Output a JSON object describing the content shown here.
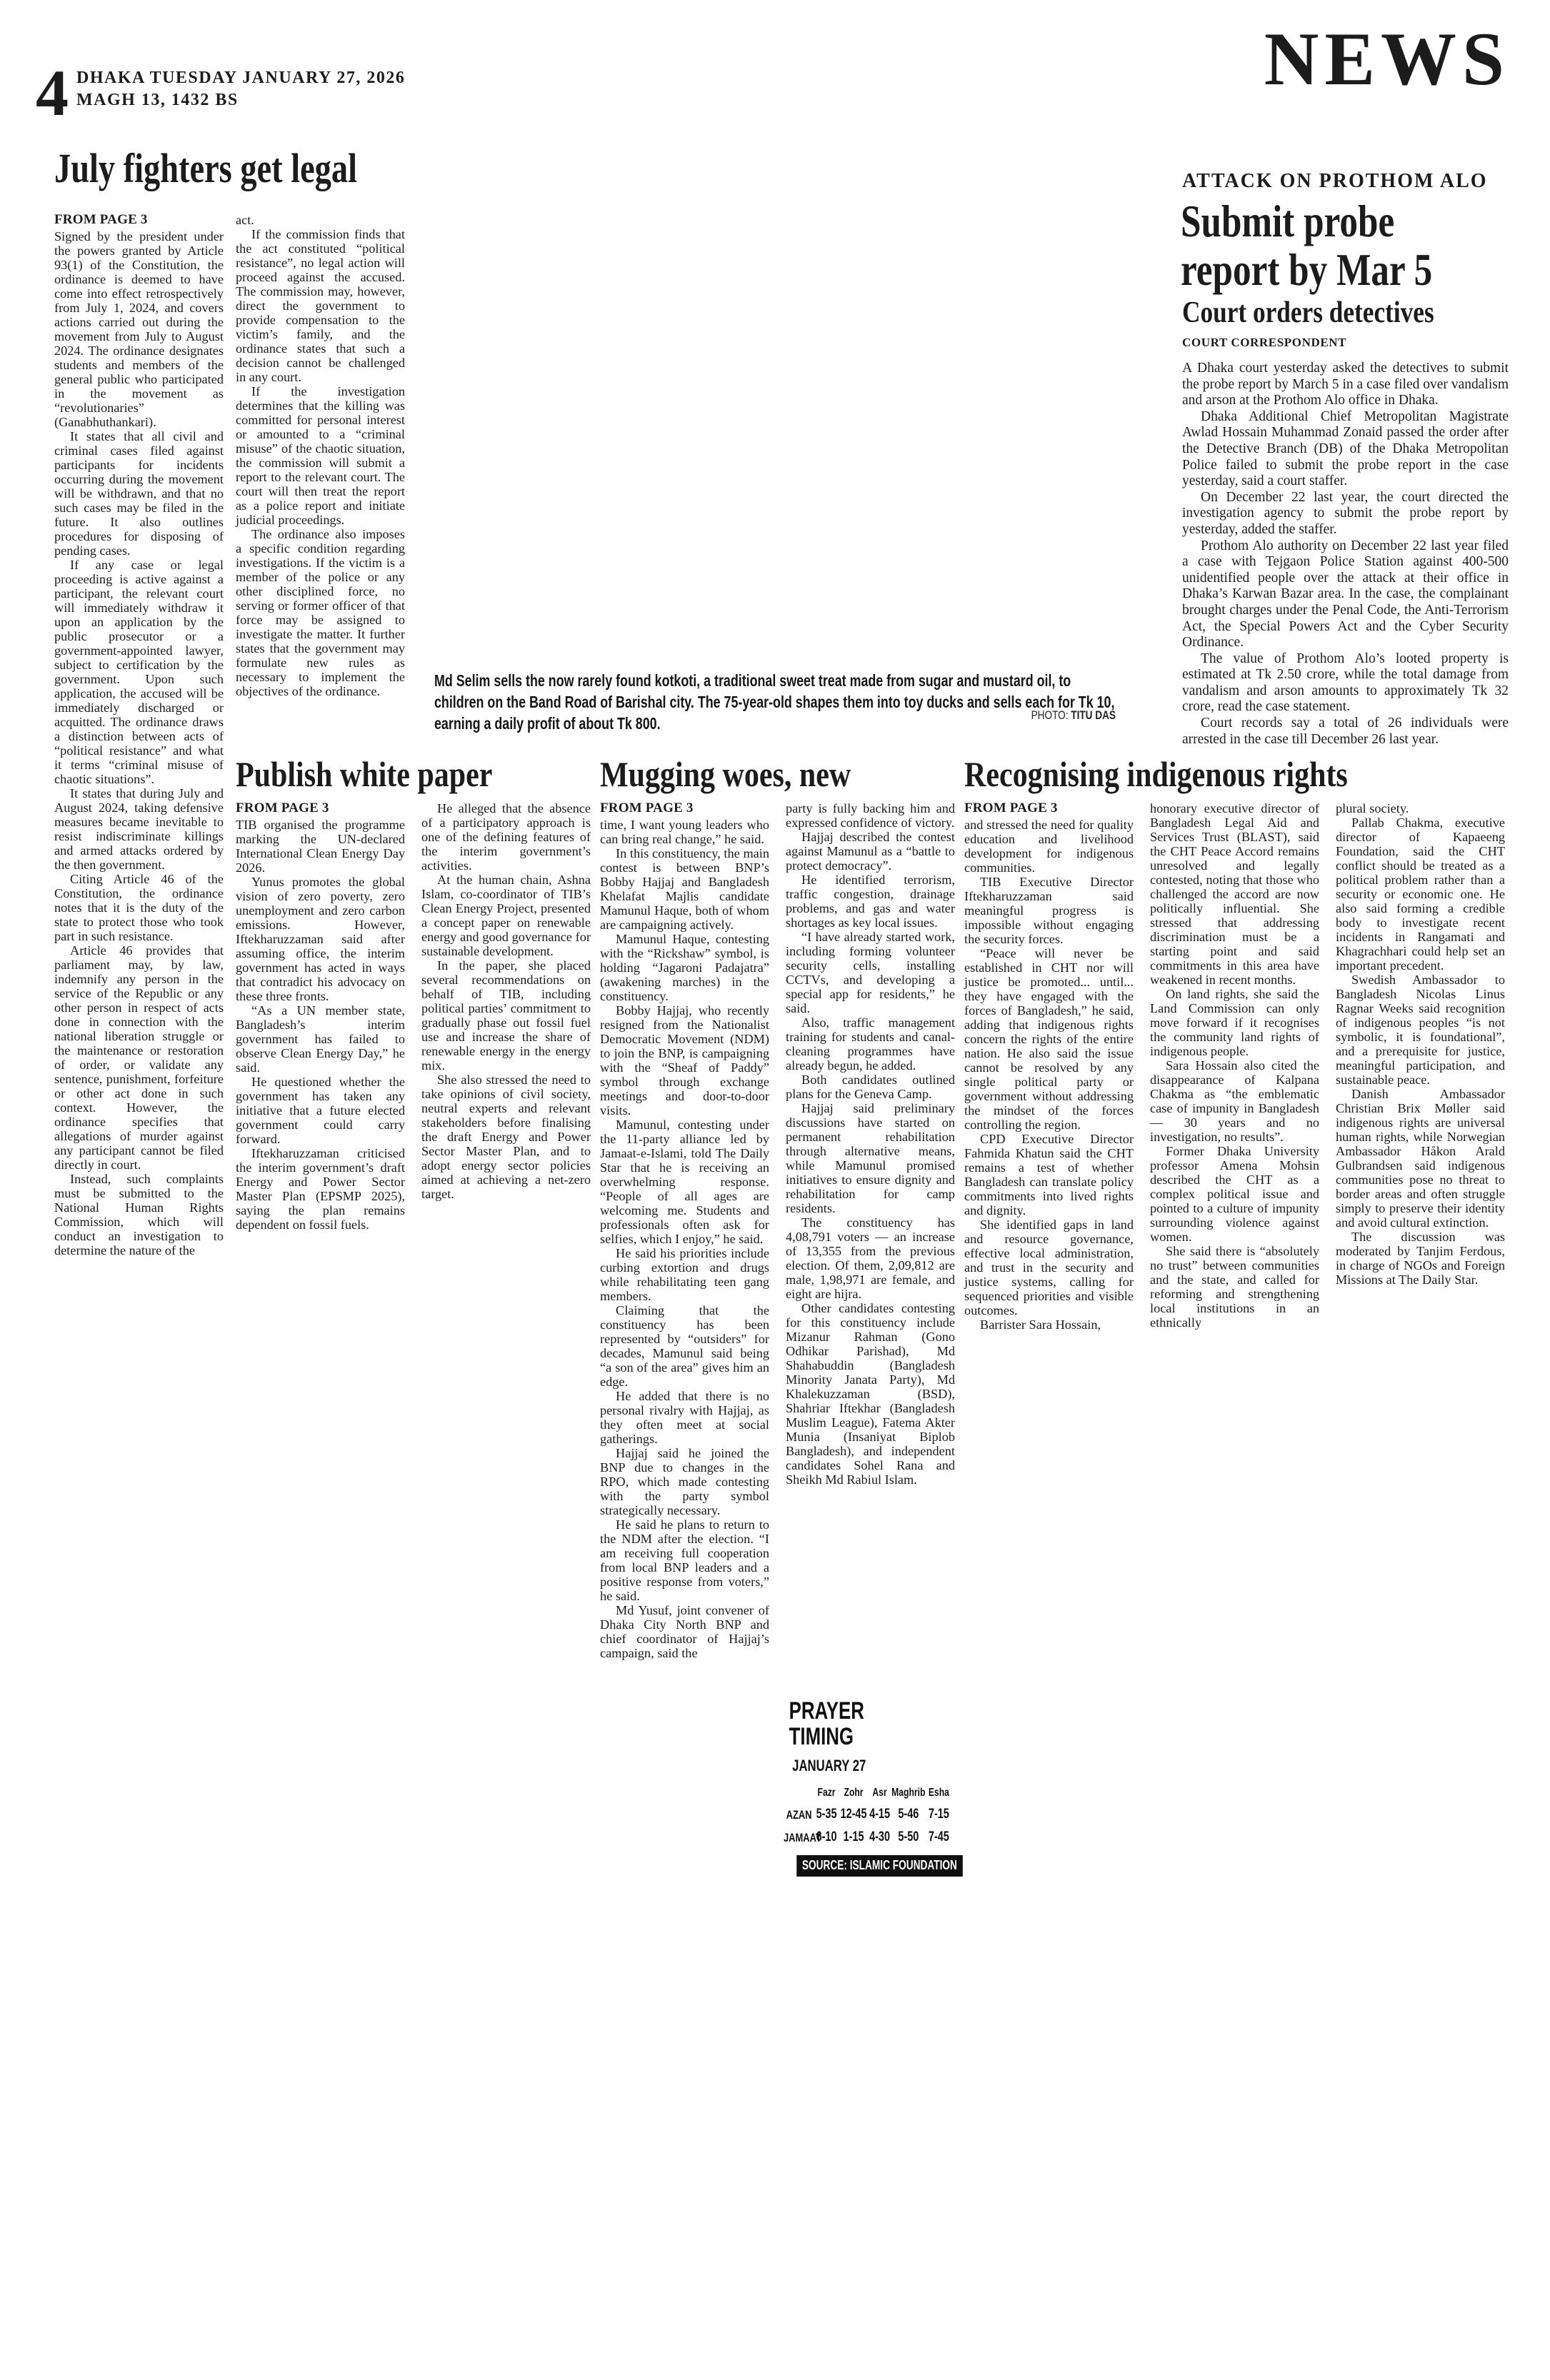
{
  "page": {
    "number": "4",
    "dateline1": "DHAKA TUESDAY JANUARY 27, 2026",
    "dateline2": "MAGH 13, 1432 BS",
    "section": "NEWS"
  },
  "articles": {
    "july": {
      "headline": "July fighters get legal",
      "from_page": "FROM PAGE 3",
      "col1": [
        "Signed by the president under the powers granted by Article 93(1) of the Constitution, the ordinance is deemed to have come into effect retrospectively from July 1, 2024, and covers actions carried out during the movement from July to August 2024. The ordinance designates students and members of the general public who participated in the movement as “revolutionaries” (Ganabhuthankari).",
        "It states that all civil and criminal cases filed against participants for incidents occurring during the movement will be withdrawn, and that no such cases may be filed in the future. It also outlines procedures for disposing of pending cases.",
        "If any case or legal proceeding is active against a participant, the relevant court will immediately withdraw it upon an application by the public prosecutor or a government-appointed lawyer, subject to certification by the government. Upon such application, the accused will be immediately discharged or acquitted. The ordinance draws a distinction between acts of “political resistance” and what it terms “criminal misuse of chaotic situations”.",
        "It states that during July and August 2024, taking defensive measures became inevitable to resist indiscriminate killings and armed attacks ordered by the then government.",
        "Citing Article 46 of the Constitution, the ordinance notes that it is the duty of the state to protect those who took part in such resistance.",
        "Article 46 provides that parliament may, by law, indemnify any person in the service of the Republic or any other person in respect of acts done in connection with the national liberation struggle or the maintenance or restoration of order, or validate any sentence, punishment, forfeiture or other act done in such context. However, the ordinance specifies that allegations of murder against any participant cannot be filed directly in court.",
        "Instead, such complaints must be submitted to the National Human Rights Commission, which will conduct an investigation to determine the nature of the"
      ],
      "col2": [
        "act.",
        "If the commission finds that the act constituted “political resistance”, no legal action will proceed against the accused. The commission may, however, direct the government to provide compensation to the victim’s family, and the ordinance states that such a decision cannot be challenged in any court.",
        "If the investigation determines that the killing was committed for personal interest or amounted to a “criminal misuse” of the chaotic situation, the commission will submit a report to the relevant court. The court will then treat the report as a police report and initiate judicial proceedings.",
        "The ordinance also imposes a specific condition regarding investigations. If the victim is a member of the police or any other disciplined force, no serving or former officer of that force may be assigned to investigate the matter. It further states that the government may formulate new rules as necessary to implement the objectives of the ordinance."
      ]
    },
    "caption": {
      "text": "Md Selim sells the now rarely found kotkoti, a traditional sweet treat made from sugar and mustard oil, to children on the Band Road of Barishal city. The 75-year-old shapes them into toy ducks and sells each for Tk 10, earning a daily profit of about Tk 800.",
      "credit_label": "PHOTO:",
      "credit_name": "TITU DAS"
    },
    "probe": {
      "kicker": "ATTACK ON PROTHOM ALO",
      "headline_line1": "Submit probe",
      "headline_line2": "report by Mar 5",
      "subhead": "Court orders detectives",
      "byline": "COURT CORRESPONDENT",
      "paras": [
        "A Dhaka court yesterday asked the detectives to submit the probe report by March 5 in a case filed over vandalism and arson at the Prothom Alo office in Dhaka.",
        "Dhaka Additional Chief Metropolitan Magistrate Awlad Hossain Muhammad Zonaid passed the order after the Detective Branch (DB) of the Dhaka Metropolitan Police failed to submit the probe report in the case yesterday, said a court staffer.",
        "On December 22 last year, the court directed the investigation agency to submit the probe report by yesterday, added the staffer.",
        "Prothom Alo authority on December 22 last year filed a case with Tejgaon Police Station against 400-500 unidentified people over the attack at their office in Dhaka’s Karwan Bazar area. In the case, the complainant brought charges under the Penal Code, the Anti-Terrorism Act, the Special Powers Act and the Cyber Security Ordinance.",
        "The value of Prothom Alo’s looted property is estimated at Tk 2.50 crore, while the total damage from vandalism and arson amounts to approximately Tk 32 crore, read the case statement.",
        "Court records say a total of 26 individuals were arrested in the case till December 26 last year."
      ]
    },
    "white_paper": {
      "headline": "Publish white paper",
      "from_page": "FROM PAGE 3",
      "col1": [
        "TIB organised the programme marking the UN-declared International Clean Energy Day 2026.",
        "Yunus promotes the global vision of zero poverty, zero unemployment and zero carbon emissions. However, Iftekharuzzaman said after assuming office, the interim government has acted in ways that contradict his advocacy on these three fronts.",
        "“As a UN member state, Bangladesh’s interim government has failed to observe Clean Energy Day,” he said.",
        "He questioned whether the government has taken any initiative that a future elected government could carry forward.",
        "Iftekharuzzaman criticised the interim government’s draft Energy and Power Sector Master Plan (EPSMP 2025), saying the plan remains dependent on fossil fuels."
      ],
      "col2": [
        "He alleged that the absence of a participatory approach is one of the defining features of the interim government’s activities.",
        "At the human chain, Ashna Islam, co-coordinator of TIB’s Clean Energy Project, presented a concept paper on renewable energy and good governance for sustainable development.",
        "In the paper, she placed several recommendations on behalf of TIB, including political parties’ commitment to gradually phase out fossil fuel use and increase the share of renewable energy in the energy mix.",
        "She also stressed the need to take opinions of civil society, neutral experts and relevant stakeholders before finalising the draft Energy and Power Sector Master Plan, and to adopt energy sector policies aimed at achieving a net-zero target."
      ]
    },
    "mugging": {
      "headline": "Mugging woes, new",
      "from_page": "FROM PAGE 3",
      "col1": [
        "time, I want young leaders who can bring real change,” he said.",
        "In this constituency, the main contest is between BNP’s Bobby Hajjaj and Bangladesh Khelafat Majlis candidate Mamunul Haque, both of whom are campaigning actively.",
        "Mamunul Haque, contesting with the “Rickshaw” symbol, is holding “Jagaroni Padajatra” (awakening marches) in the constituency.",
        "Bobby Hajjaj, who recently resigned from the Nationalist Democratic Movement (NDM) to join the BNP, is campaigning with the “Sheaf of Paddy” symbol through exchange meetings and door-to-door visits.",
        "Mamunul, contesting under the 11-party alliance led by Jamaat-e-Islami, told The Daily Star that he is receiving an overwhelming response. “People of all ages are welcoming me. Students and professionals often ask for selfies, which I enjoy,” he said.",
        "He said his priorities include curbing extortion and drugs while rehabilitating teen gang members.",
        "Claiming that the constituency has been represented by “outsiders” for decades, Mamunul said being “a son of the area” gives him an edge.",
        "He added that there is no personal rivalry with Hajjaj, as they often meet at social gatherings.",
        "Hajjaj said he joined the BNP due to changes in the RPO, which made contesting with the party symbol strategically necessary.",
        "He said he plans to return to the NDM after the election. “I am receiving full cooperation from local BNP leaders and a positive response from voters,” he said.",
        "Md Yusuf, joint convener of Dhaka City North BNP and chief coordinator of Hajjaj’s campaign, said the"
      ],
      "col2": [
        "party is fully backing him and expressed confidence of victory.",
        "Hajjaj described the contest against Mamunul as a “battle to protect democracy”.",
        "He identified terrorism, traffic congestion, drainage problems, and gas and water shortages as key local issues.",
        "“I have already started work, including forming volunteer security cells, installing CCTVs, and developing a special app for residents,” he said.",
        "Also, traffic management training for students and canal-cleaning programmes have already begun, he added.",
        "Both candidates outlined plans for the Geneva Camp.",
        "Hajjaj said preliminary discussions have started on permanent rehabilitation through alternative means, while Mamunul promised initiatives to ensure dignity and rehabilitation for camp residents.",
        "The constituency has 4,08,791 voters — an increase of 13,355 from the previous election. Of them, 2,09,812 are male, 1,98,971 are female, and eight are hijra.",
        "Other candidates contesting for this constituency include Mizanur Rahman (Gono Odhikar Parishad), Md Shahabuddin (Bangladesh Minority Janata Party), Md Khalekuzzaman (BSD), Shahriar Iftekhar (Bangladesh Muslim League), Fatema Akter Munia (Insaniyat Biplob Bangladesh), and independent candidates Sohel Rana and Sheikh Md Rabiul Islam."
      ]
    },
    "indigenous": {
      "headline": "Recognising indigenous rights",
      "from_page": "FROM PAGE 3",
      "col1": [
        "and stressed the need for quality education and livelihood development for indigenous communities.",
        "TIB Executive Director Iftekharuzzaman said meaningful progress is impossible without engaging the security forces.",
        "“Peace will never be established in CHT nor will justice be promoted... until... they have engaged with the forces of Bangladesh,” he said, adding that indigenous rights concern the rights of the entire nation. He also said the issue cannot be resolved by any single political party or government without addressing the mindset of the forces controlling the region.",
        "CPD Executive Director Fahmida Khatun said the CHT remains a test of whether Bangladesh can translate policy commitments into lived rights and dignity.",
        "She identified gaps in land and resource governance, effective local administration, and trust in the security and justice systems, calling for sequenced priorities and visible outcomes.",
        "Barrister Sara Hossain,"
      ],
      "col2": [
        "honorary executive director of Bangladesh Legal Aid and Services Trust (BLAST), said the CHT Peace Accord remains unresolved and legally contested, noting that those who challenged the accord are now politically influential. She stressed that addressing discrimination must be a starting point and said commitments in this area have weakened in recent months.",
        "On land rights, she said the Land Commission can only move forward if it recognises the community land rights of indigenous people.",
        "Sara Hossain also cited the disappearance of Kalpana Chakma as “the emblematic case of impunity in Bangladesh — 30 years and no investigation, no results”.",
        "Former Dhaka University professor Amena Mohsin described the CHT as a complex political issue and pointed to a culture of impunity surrounding violence against women.",
        "She said there is “absolutely no trust” between communities and the state, and called for reforming and strengthening local institutions in an ethnically"
      ],
      "col3": [
        "plural society.",
        "Pallab Chakma, executive director of Kapaeeng Foundation, said the CHT conflict should be treated as a political problem rather than a security or economic one. He also said forming a credible body to investigate recent incidents in Rangamati and Khagrachhari could help set an important precedent.",
        "Swedish Ambassador to Bangladesh Nicolas Linus Ragnar Weeks said recognition of indigenous peoples “is not symbolic, it is foundational”, and a prerequisite for justice, meaningful participation, and sustainable peace.",
        "Danish Ambassador Christian Brix Møller said indigenous rights are universal human rights, while Norwegian Ambassador Håkon Arald Gulbrandsen said indigenous communities pose no threat to border areas and often struggle simply to preserve their identity and avoid cultural extinction.",
        "The discussion was moderated by Tanjim Ferdous, in charge of NGOs and Foreign Missions at The Daily Star."
      ]
    }
  },
  "prayer": {
    "title_line1": "PRAYER",
    "title_line2": "TIMING",
    "date": "JANUARY 27",
    "columns": [
      "Fazr",
      "Zohr",
      "Asr",
      "Maghrib",
      "Esha"
    ],
    "rows": [
      {
        "label": "AZAN",
        "values": [
          "5-35",
          "12-45",
          "4-15",
          "5-46",
          "7-15"
        ]
      },
      {
        "label": "JAMAAT",
        "values": [
          "6-10",
          "1-15",
          "4-30",
          "5-50",
          "7-45"
        ]
      }
    ],
    "source": "SOURCE: ISLAMIC FOUNDATION"
  }
}
